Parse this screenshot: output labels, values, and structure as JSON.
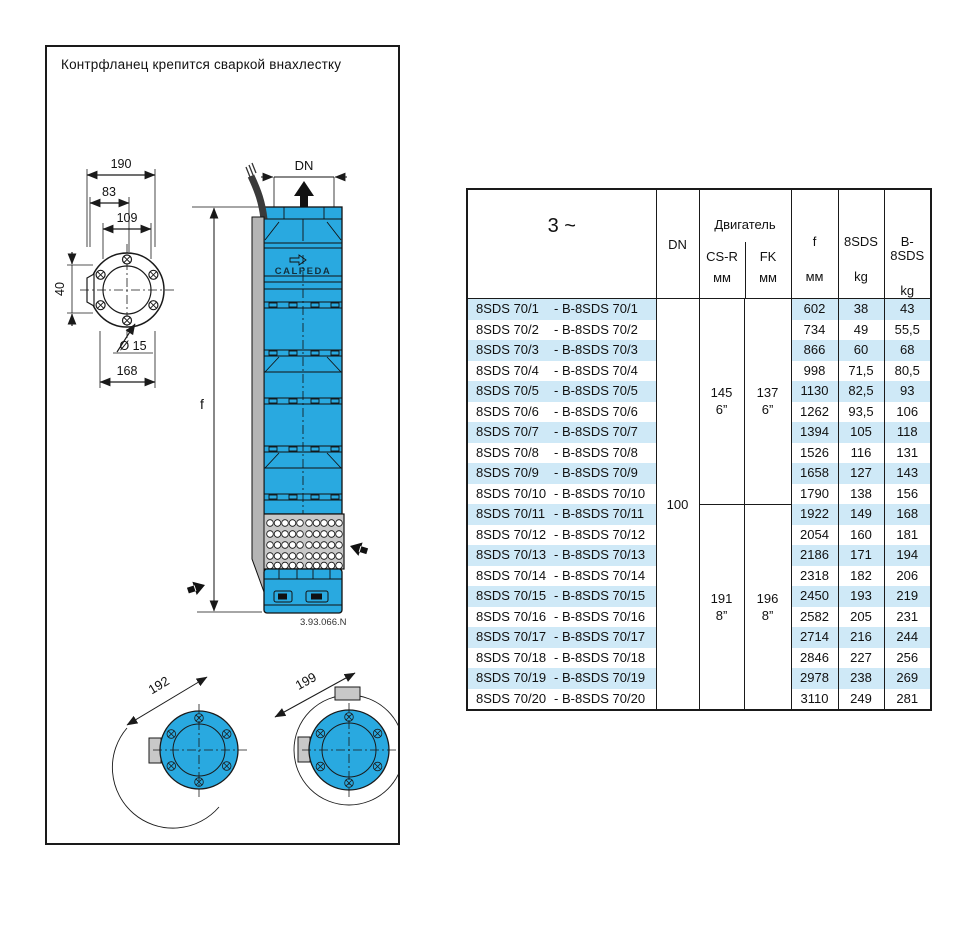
{
  "panel": {
    "caption": "Контрфланец крепится сваркой внахлестку"
  },
  "drawing": {
    "brand": "CALPEDA",
    "number": "3.93.066.N",
    "dn": "DN",
    "f": "f",
    "d190": "190",
    "d83": "83",
    "d109": "109",
    "d40": "40",
    "d15": "Ø 15",
    "d168": "168",
    "d192": "192",
    "d199": "199"
  },
  "table": {
    "header": {
      "phase": "3 ~",
      "dn": "DN",
      "motor": "Двигатель",
      "cs_r": "CS-R",
      "fk": "FK",
      "mm": "мм",
      "f": "f",
      "w8sds": "8SDS",
      "wb8sds": "B-8SDS",
      "kg": "kg"
    },
    "dn_value": "100",
    "motor_groups": [
      {
        "cs_r": "145",
        "fk": "137",
        "size": "6”"
      },
      {
        "cs_r": "191",
        "fk": "196",
        "size": "8”"
      }
    ],
    "rows": [
      {
        "model": "8SDS 70/1",
        "b_model": "- B-8SDS 70/1",
        "f": "602",
        "kg_8sds": "38",
        "kg_b8sds": "43"
      },
      {
        "model": "8SDS 70/2",
        "b_model": "- B-8SDS 70/2",
        "f": "734",
        "kg_8sds": "49",
        "kg_b8sds": "55,5"
      },
      {
        "model": "8SDS 70/3",
        "b_model": "- B-8SDS 70/3",
        "f": "866",
        "kg_8sds": "60",
        "kg_b8sds": "68"
      },
      {
        "model": "8SDS 70/4",
        "b_model": "- B-8SDS 70/4",
        "f": "998",
        "kg_8sds": "71,5",
        "kg_b8sds": "80,5"
      },
      {
        "model": "8SDS 70/5",
        "b_model": "- B-8SDS 70/5",
        "f": "1130",
        "kg_8sds": "82,5",
        "kg_b8sds": "93"
      },
      {
        "model": "8SDS 70/6",
        "b_model": "- B-8SDS 70/6",
        "f": "1262",
        "kg_8sds": "93,5",
        "kg_b8sds": "106"
      },
      {
        "model": "8SDS 70/7",
        "b_model": "- B-8SDS 70/7",
        "f": "1394",
        "kg_8sds": "105",
        "kg_b8sds": "118"
      },
      {
        "model": "8SDS 70/8",
        "b_model": "- B-8SDS 70/8",
        "f": "1526",
        "kg_8sds": "116",
        "kg_b8sds": "131"
      },
      {
        "model": "8SDS 70/9",
        "b_model": "- B-8SDS 70/9",
        "f": "1658",
        "kg_8sds": "127",
        "kg_b8sds": "143"
      },
      {
        "model": "8SDS 70/10",
        "b_model": "- B-8SDS 70/10",
        "f": "1790",
        "kg_8sds": "138",
        "kg_b8sds": "156"
      },
      {
        "model": "8SDS 70/11",
        "b_model": "- B-8SDS 70/11",
        "f": "1922",
        "kg_8sds": "149",
        "kg_b8sds": "168"
      },
      {
        "model": "8SDS 70/12",
        "b_model": "- B-8SDS 70/12",
        "f": "2054",
        "kg_8sds": "160",
        "kg_b8sds": "181"
      },
      {
        "model": "8SDS 70/13",
        "b_model": "- B-8SDS 70/13",
        "f": "2186",
        "kg_8sds": "171",
        "kg_b8sds": "194"
      },
      {
        "model": "8SDS 70/14",
        "b_model": "- B-8SDS 70/14",
        "f": "2318",
        "kg_8sds": "182",
        "kg_b8sds": "206"
      },
      {
        "model": "8SDS 70/15",
        "b_model": "- B-8SDS 70/15",
        "f": "2450",
        "kg_8sds": "193",
        "kg_b8sds": "219"
      },
      {
        "model": "8SDS 70/16",
        "b_model": "- B-8SDS 70/16",
        "f": "2582",
        "kg_8sds": "205",
        "kg_b8sds": "231"
      },
      {
        "model": "8SDS 70/17",
        "b_model": "- B-8SDS 70/17",
        "f": "2714",
        "kg_8sds": "216",
        "kg_b8sds": "244"
      },
      {
        "model": "8SDS 70/18",
        "b_model": "- B-8SDS 70/18",
        "f": "2846",
        "kg_8sds": "227",
        "kg_b8sds": "256"
      },
      {
        "model": "8SDS 70/19",
        "b_model": "- B-8SDS 70/19",
        "f": "2978",
        "kg_8sds": "238",
        "kg_b8sds": "269"
      },
      {
        "model": "8SDS 70/20",
        "b_model": "- B-8SDS 70/20",
        "f": "3110",
        "kg_8sds": "249",
        "kg_b8sds": "281"
      }
    ]
  },
  "colors": {
    "pump_blue": "#29a9e0",
    "stripe_blue": "#cfe9f7",
    "strainer_gray": "#c8c8c8",
    "line": "#1a1a1a"
  }
}
